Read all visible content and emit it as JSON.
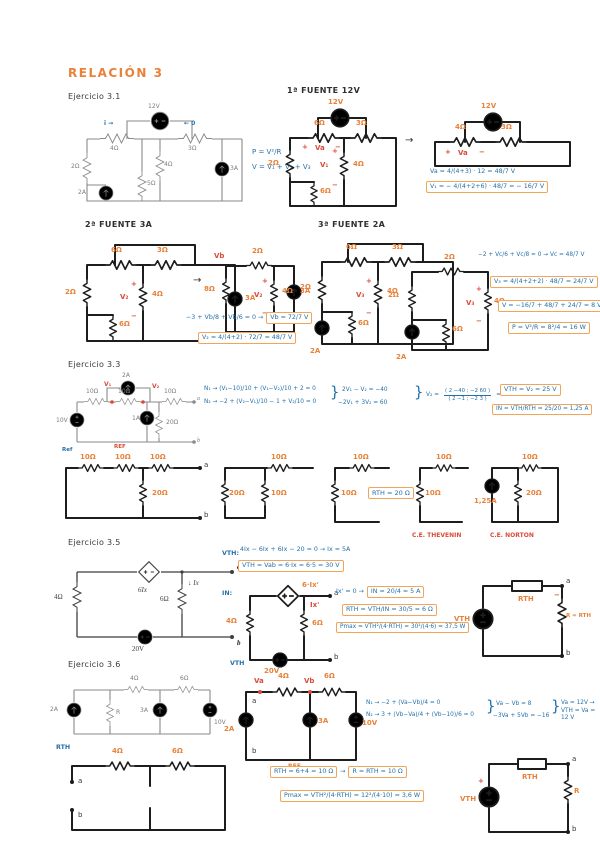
{
  "title": "RELACIÓN 3",
  "colors": {
    "orange": "#e8823a",
    "blue": "#2470a8",
    "red": "#d94b38",
    "ink": "#1d1d1d",
    "print": "#8a8a8a"
  },
  "sym": {
    "brace": "}",
    "arrow": "→"
  },
  "ex31": {
    "label": "Ejercicio 3.1",
    "printed": {
      "v": "12V",
      "i": "i →",
      "o": "← 0",
      "r1": "4Ω",
      "r2": "3Ω",
      "r3": "2Ω",
      "r4": "4Ω",
      "r5": "5Ω",
      "s1": "2A",
      "s2": "3A"
    },
    "notes": {
      "p": "P = V²/R",
      "v": "V = V₁ + V₂ + V₃"
    },
    "f1": {
      "heading": "1ª FUENTE  12V",
      "a": {
        "v": "12V",
        "r1": "6Ω",
        "r2": "3Ω",
        "r3": "2Ω",
        "r4": "4Ω",
        "r5": "6Ω",
        "plus": "+",
        "va": "Va",
        "minus": "−",
        "v1": "V₁"
      },
      "b": {
        "v": "12V",
        "r1": "4Ω",
        "r2": "3Ω",
        "plus": "+",
        "va": "Va",
        "minus": "−"
      },
      "eq1": "Va = 4/(4+3) · 12 = 48/7 V",
      "eq2": "V₁ = − 4/(4+2+6) · 48/7 = − 16/7 V"
    },
    "f2": {
      "heading": "2ª FUENTE  3A",
      "a": {
        "r1": "6Ω",
        "r2": "3Ω",
        "r3": "2Ω",
        "r4": "4Ω",
        "r5": "6Ω",
        "s": "3A",
        "plus": "+",
        "v2": "V₂",
        "minus": "−"
      },
      "b": {
        "vb": "Vb",
        "r1": "2Ω",
        "r2": "8Ω",
        "r3": "4Ω",
        "s": "3A",
        "plus": "+",
        "v2": "V₂",
        "minus": "−"
      },
      "eq1": "−3 + Vb/8 + Vb/6 = 0  →",
      "eq1box": "Vb = 72/7 V",
      "eq2box": "V₂ = 4/(4+2) · 72/7 = 48/7 V"
    },
    "f3": {
      "heading": "3ª FUENTE  2A",
      "a": {
        "r1": "6Ω",
        "r2": "3Ω",
        "r3": "2Ω",
        "r4": "4Ω",
        "r5": "6Ω",
        "s": "2A",
        "plus": "+",
        "v3": "V₃",
        "minus": "−"
      },
      "b": {
        "r1": "2Ω",
        "r2": "2Ω",
        "r3": "4Ω",
        "r4": "6Ω",
        "s": "2A",
        "plus": "+",
        "v3": "V₃",
        "minus": "−"
      },
      "eq1": "−2 + Vc/6 + Vc/8 = 0 → Vc = 48/7 V",
      "eq2box": "V₃ = 4/(4+2+2) · 48/7 = 24/7 V",
      "eq3box": "V = −16/7 + 48/7 + 24/7 = 8 V",
      "eq4box": "P = V²/R = 8²/4 = 16 W"
    }
  },
  "ex33": {
    "label": "Ejercicio 3.3",
    "printed": {
      "s1": "2A",
      "r1": "10Ω",
      "r2": "10Ω",
      "r3": "10Ω",
      "s2": "1A",
      "r4": "20Ω",
      "vs": "10V",
      "v1": "V₁",
      "v2": "V₂",
      "ref": "REF",
      "refb": "Ref",
      "a": "a",
      "b": "b"
    },
    "n1": "N₁ → (V₁−10)/10 + (V₁−V₂)/10 + 2 = 0",
    "n2": "N₂ → −2 + (V₂−V₁)/10 − 1 + V₂/10 = 0",
    "s1": "2V₁ − V₂ = −40",
    "s2": "−2V₁ + 3V₂ = 60",
    "v2pre": "V₂ =",
    "mnum": "( 2  −40 ; −2  60 )",
    "mden": "( 2  −1 ; −2  3 )",
    "v2res": "= 25 V",
    "vthbox": "VTH = V₂ = 25 V",
    "inbox": "IN = VTH/RTH = 25/20 = 1,25 A",
    "c1": {
      "r1": "10Ω",
      "r2": "10Ω",
      "r3": "10Ω",
      "r4": "20Ω",
      "a": "a",
      "b": "b"
    },
    "c2": {
      "r1": "10Ω",
      "r2": "20Ω",
      "r3": "10Ω"
    },
    "c3": {
      "r1": "10Ω",
      "r2": "10Ω"
    },
    "rthbox": "RTH = 20 Ω",
    "c4": {
      "r1": "10Ω",
      "r2": "10Ω",
      "cap": "C.E. THEVENIN"
    },
    "c5": {
      "r1": "10Ω",
      "r2": "20Ω",
      "s": "1,25A",
      "cap": "C.E. NORTON"
    }
  },
  "ex35": {
    "label": "Ejercicio 3.5",
    "printed": {
      "r1": "4Ω",
      "d": "6Ix",
      "r2": "6Ω",
      "ix": "↓ Ix",
      "vs": "20V",
      "a": "a",
      "b": "b"
    },
    "vthlbl": "VTH:",
    "inlbl": "IN:",
    "eq1": "4Ix − 6Ix + 6Ix − 20 = 0  →  Ix = 5A",
    "eq2box": "VTH = Vab = 6·Ix = 6·5 = 30 V",
    "h": {
      "d": "6·Ix'",
      "r1": "4Ω",
      "r2": "6Ω",
      "ix": "Ix'",
      "vs": "20V",
      "a": "a",
      "b": "b"
    },
    "eq3": "Ix' = 0  →",
    "eq3box": "IN = 20/4 = 5 A",
    "eq4box": "RTH = VTH/IN = 30/5 = 6 Ω",
    "eq5box": "Pmax = VTH²/(4·RTH) = 30²/(4·6) = 37,5 W",
    "t": {
      "vth": "VTH",
      "rth": "RTH",
      "r": "R = RTH",
      "a": "a",
      "b": "b",
      "minus": "−"
    }
  },
  "ex36": {
    "label": "Ejercicio 3.6",
    "printed": {
      "s1": "2A",
      "r": "R",
      "r1": "4Ω",
      "s2": "3A",
      "r2": "6Ω",
      "vs": "10V"
    },
    "vthlbl": "VTH",
    "h": {
      "va": "Va",
      "vb": "Vb",
      "r1": "4Ω",
      "r2": "6Ω",
      "s1": "2A",
      "s2": "3A",
      "vs": "10V",
      "ref": "REF",
      "a": "a",
      "b": "b"
    },
    "n1": "N₁ → −2 + (Va−Vb)/4 = 0",
    "n2": "N₂ → 3 + (Vb−Va)/4 + (Vb−10)/6 = 0",
    "s1": "Va − Vb = 8",
    "s2": "−3Va + 5Vb = −16",
    "res": "Va = 12V → VTH = Va = 12 V",
    "rthlbl": "RTH",
    "r": {
      "r1": "4Ω",
      "r2": "6Ω",
      "a": "a",
      "b": "b"
    },
    "eqr1box": "RTH = 6+4 = 10 Ω",
    "eqr2box": "R = RTH = 10 Ω",
    "eqr3box": "Pmax = VTH²/(4·RTH) = 12²/(4·10) = 3,6 W",
    "t": {
      "vth": "VTH",
      "rth": "RTH",
      "r": "R",
      "a": "a",
      "b": "b",
      "plus": "+"
    }
  }
}
